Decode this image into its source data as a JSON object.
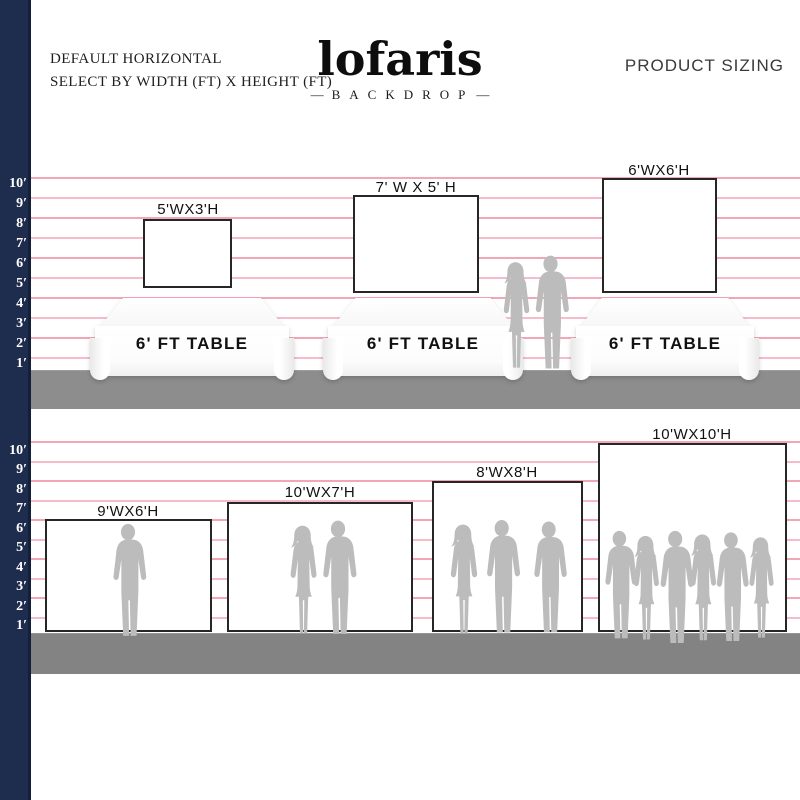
{
  "header": {
    "subtitle_line1": "DEFAULT HORIZONTAL",
    "subtitle_line2": "SELECT BY WIDTH (FT) X HEIGHT (FT)",
    "logo_text": "lofaris",
    "logo_tagline": "BACKDROP",
    "logo_dash": "—",
    "product_sizing": "PRODUCT SIZING"
  },
  "ruler": {
    "labels": [
      "10′",
      "9′",
      "8′",
      "7′",
      "6′",
      "5′",
      "4′",
      "3′",
      "2′",
      "1′"
    ]
  },
  "top_section": {
    "table_label": "6' FT TABLE",
    "backdrops": [
      {
        "label": "5'WX3'H",
        "width_ft": 5,
        "height_ft": 3
      },
      {
        "label": "7' W X 5' H",
        "width_ft": 7,
        "height_ft": 5
      },
      {
        "label": "6'WX6'H",
        "width_ft": 6,
        "height_ft": 6
      }
    ]
  },
  "bottom_section": {
    "backdrops": [
      {
        "label": "9'WX6'H",
        "width_ft": 9,
        "height_ft": 6
      },
      {
        "label": "10'WX7'H",
        "width_ft": 10,
        "height_ft": 7
      },
      {
        "label": "8'WX8'H",
        "width_ft": 8,
        "height_ft": 8
      },
      {
        "label": "10'WX10'H",
        "width_ft": 10,
        "height_ft": 10
      }
    ]
  },
  "colors": {
    "ruler_bar": "#1e2c4e",
    "grid_line": "#f2a6b6",
    "floor_top": "#8d8d8d",
    "floor_bottom": "#838383",
    "silhouette": "#bcbcbc",
    "backdrop_border": "#262626"
  }
}
